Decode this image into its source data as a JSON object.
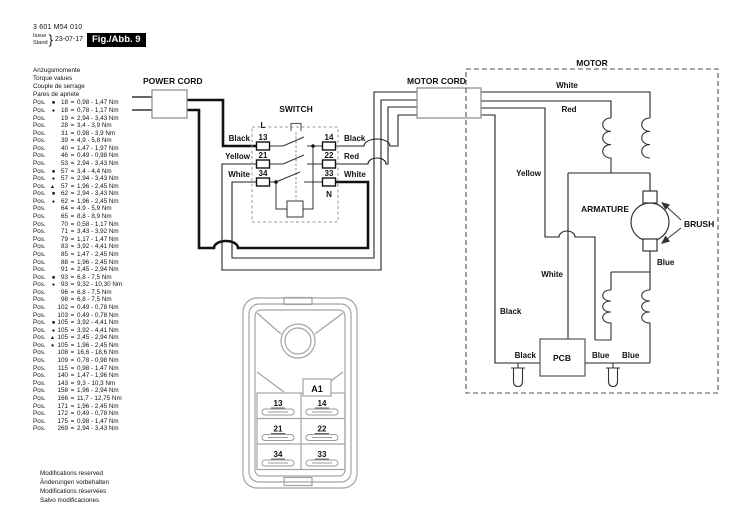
{
  "header": {
    "part_number": "3 601 M54 010",
    "issue_label": "Issue",
    "stand_label": "Stand",
    "brace": "}",
    "date": "23-07-17",
    "figure_badge": "Fig./Abb. 9"
  },
  "torque_table": {
    "headings": [
      "Anzugsmomente",
      "Torque values",
      "Couple de serrage",
      "Pares de apriete"
    ],
    "pos_label": "Pos.",
    "eq": "=",
    "rows": [
      {
        "sym": "■",
        "num": "18",
        "val": "0,98 - 1,47 Nm"
      },
      {
        "sym": "●",
        "num": "18",
        "val": "0,78 - 1,17 Nm"
      },
      {
        "sym": "",
        "num": "19",
        "val": "2,94 - 3,43 Nm"
      },
      {
        "sym": "",
        "num": "28",
        "val": "3,4 - 3,9 Nm"
      },
      {
        "sym": "",
        "num": "31",
        "val": "0,98 - 3,9 Nm"
      },
      {
        "sym": "",
        "num": "39",
        "val": "4,9 - 5,8 Nm"
      },
      {
        "sym": "",
        "num": "40",
        "val": "1,47 - 1,97 Nm"
      },
      {
        "sym": "",
        "num": "46",
        "val": "0,49 - 0,98 Nm"
      },
      {
        "sym": "",
        "num": "53",
        "val": "2,94 - 3,43 Nm"
      },
      {
        "sym": "■",
        "num": "57",
        "val": "3,4 - 4,4 Nm"
      },
      {
        "sym": "●",
        "num": "57",
        "val": "2,94 - 3,43 Nm"
      },
      {
        "sym": "▲",
        "num": "57",
        "val": "1,96 - 2,45 Nm"
      },
      {
        "sym": "■",
        "num": "62",
        "val": "2,94 - 3,43 Nm"
      },
      {
        "sym": "●",
        "num": "62",
        "val": "1,96 - 2,45 Nm"
      },
      {
        "sym": "",
        "num": "64",
        "val": "4,9 - 5,9 Nm"
      },
      {
        "sym": "",
        "num": "65",
        "val": "8,8 - 8,9 Nm"
      },
      {
        "sym": "",
        "num": "70",
        "val": "0,58 - 1,17 Nm"
      },
      {
        "sym": "",
        "num": "71",
        "val": "3,43 - 3,92 Nm"
      },
      {
        "sym": "",
        "num": "79",
        "val": "1,17 - 1,47 Nm"
      },
      {
        "sym": "",
        "num": "83",
        "val": "3,92 - 4,41 Nm"
      },
      {
        "sym": "",
        "num": "85",
        "val": "1,47 - 2,45 Nm"
      },
      {
        "sym": "",
        "num": "88",
        "val": "1,96 - 2,45 Nm"
      },
      {
        "sym": "",
        "num": "91",
        "val": "2,45 - 2,94 Nm"
      },
      {
        "sym": "■",
        "num": "93",
        "val": "6,8 - 7,5 Nm"
      },
      {
        "sym": "●",
        "num": "93",
        "val": "9,32 - 10,30 Nm"
      },
      {
        "sym": "",
        "num": "96",
        "val": "6,8 - 7,5 Nm"
      },
      {
        "sym": "",
        "num": "98",
        "val": "6,8 - 7,5 Nm"
      },
      {
        "sym": "",
        "num": "102",
        "val": "0,49 - 0,78 Nm"
      },
      {
        "sym": "",
        "num": "103",
        "val": "0,49 - 0,78 Nm"
      },
      {
        "sym": "■",
        "num": "105",
        "val": "3,92 - 4,41 Nm"
      },
      {
        "sym": "●",
        "num": "105",
        "val": "3,92 - 4,41 Nm"
      },
      {
        "sym": "▲",
        "num": "105",
        "val": "2,45 - 2,94 Nm"
      },
      {
        "sym": "★",
        "num": "105",
        "val": "1,96 - 2,45 Nm"
      },
      {
        "sym": "",
        "num": "108",
        "val": "16,6 - 18,6 Nm"
      },
      {
        "sym": "",
        "num": "109",
        "val": "0,78 - 0,98 Nm"
      },
      {
        "sym": "",
        "num": "115",
        "val": "0,98 - 1,47 Nm"
      },
      {
        "sym": "",
        "num": "140",
        "val": "1,47 - 1,96 Nm"
      },
      {
        "sym": "",
        "num": "143",
        "val": "9,3 - 10,3 Nm"
      },
      {
        "sym": "",
        "num": "158",
        "val": "1,96 - 2,94 Nm"
      },
      {
        "sym": "",
        "num": "166",
        "val": "11,7 - 12,75 Nm"
      },
      {
        "sym": "",
        "num": "171",
        "val": "1,96 - 2,45 Nm"
      },
      {
        "sym": "",
        "num": "172",
        "val": "0,49 - 0,78 Nm"
      },
      {
        "sym": "",
        "num": "175",
        "val": "0,98 - 1,47 Nm"
      },
      {
        "sym": "",
        "num": "269",
        "val": "2,94 - 3,43 Nm"
      }
    ]
  },
  "footer": {
    "lines": [
      "Modifications reserved",
      "Änderungen vorbehalten",
      "Modifications réservées",
      "Salvo modificaciones"
    ]
  },
  "diagram": {
    "power_cord": "POWER CORD",
    "switch": "SWITCH",
    "motor_cord": "MOTOR CORD",
    "motor": "MOTOR",
    "armature": "ARMATURE",
    "brush": "BRUSH",
    "pcb": "PCB",
    "terminal_l": "L",
    "terminal_n": "N",
    "t13": "13",
    "t14": "14",
    "t21": "21",
    "t22": "22",
    "t34": "34",
    "t33": "33",
    "wire_in_black": "Black",
    "wire_in_yellow": "Yellow",
    "wire_in_white": "White",
    "wire_out_black": "Black",
    "wire_out_red": "Red",
    "wire_out_white": "White",
    "motor_white_top": "White",
    "motor_red": "Red",
    "motor_yellow": "Yellow",
    "motor_white_tap": "White",
    "motor_black": "Black",
    "motor_black_pcb": "Black",
    "motor_blue_armature": "Blue",
    "motor_blue_pcb1": "Blue",
    "motor_blue_pcb2": "Blue"
  },
  "switch_detail": {
    "a1": "A1",
    "t13": "13",
    "t14": "14",
    "t21": "21",
    "t22": "22",
    "t34": "34",
    "t33": "33"
  }
}
